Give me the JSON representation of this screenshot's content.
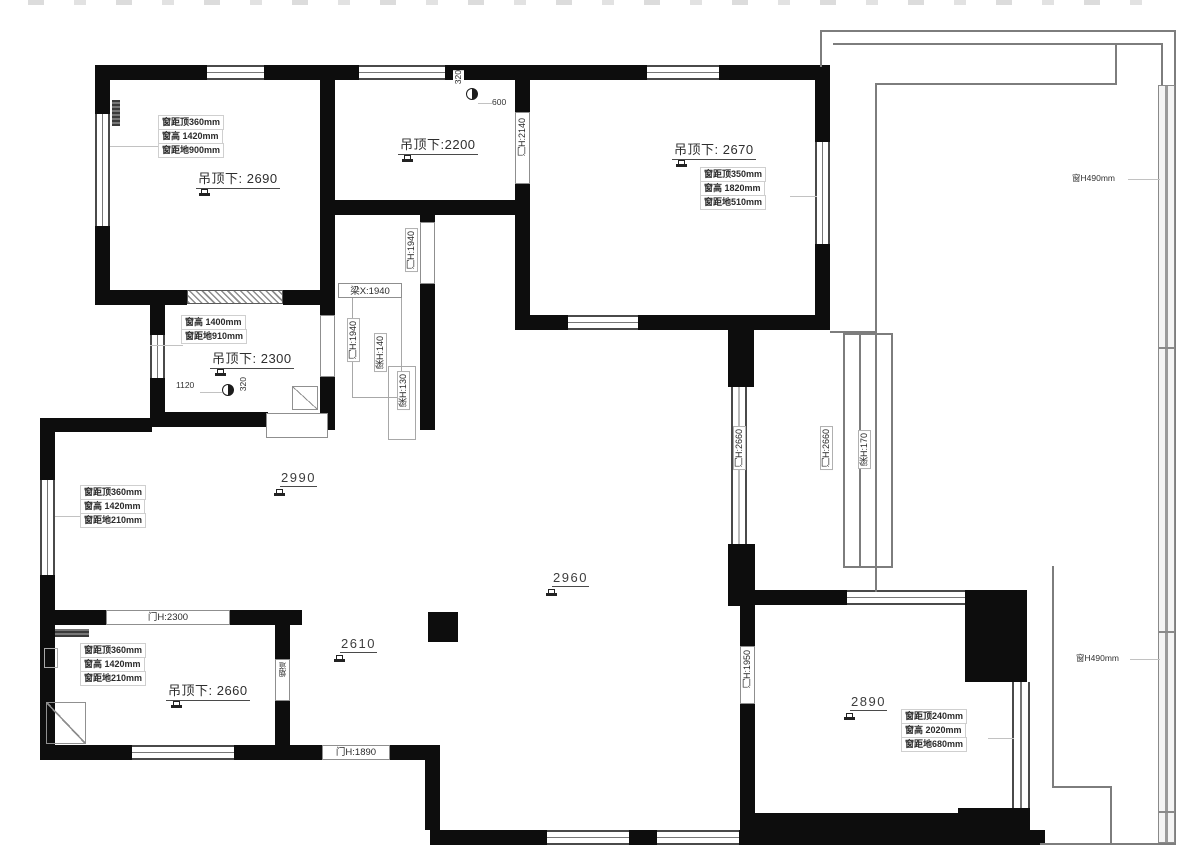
{
  "annotations": {
    "room_a": {
      "ceiling": "吊顶下: 2690",
      "win": [
        "窗距顶360mm",
        "窗高 1420mm",
        "窗距地900mm"
      ]
    },
    "room_b": {
      "ceiling": "吊顶下:2200",
      "dim_offset": "600",
      "dim_side": "320",
      "door": "门H:2140"
    },
    "room_c": {
      "ceiling": "吊顶下: 2670",
      "win": [
        "窗距顶350mm",
        "窗高 1820mm",
        "窗距地510mm"
      ]
    },
    "room_mid": {
      "ceiling": "吊顶下: 2300",
      "win": [
        "窗高 1400mm",
        "窗距地910mm"
      ],
      "dim": "1120",
      "dim_side": "320"
    },
    "living": {
      "marks": [
        "2990",
        "2960",
        "2610"
      ],
      "left_win": [
        "窗距顶360mm",
        "窗高 1420mm",
        "窗距地210mm"
      ]
    },
    "kitchen": {
      "ceiling": "吊顶下: 2660",
      "win": [
        "窗距顶360mm",
        "窗高 1420mm",
        "窗距地210mm"
      ],
      "door": "门H:2300",
      "flue": "烟道"
    },
    "room_e": {
      "mark": "2890",
      "win": [
        "窗距顶240mm",
        "窗高 2020mm",
        "窗距地680mm"
      ],
      "door": "门H:1950"
    },
    "corridor": {
      "beam_x": "梁X:1940",
      "doors": [
        "门H:1940",
        "门H:1940"
      ],
      "beams": [
        "梁H:140",
        "梁H:130"
      ]
    },
    "passage": {
      "doors": [
        "门H:2660",
        "门H:2660"
      ],
      "beam": "梁H:170"
    },
    "south_door": "门H:1890",
    "balcony": {
      "rails": [
        "窗H490mm",
        "窗H490mm"
      ]
    }
  },
  "colors": {
    "wall": "#0d0d0d",
    "thin_line": "#7d7d7d",
    "leader": "#c2c2c2",
    "text": "#2a2a2a"
  }
}
